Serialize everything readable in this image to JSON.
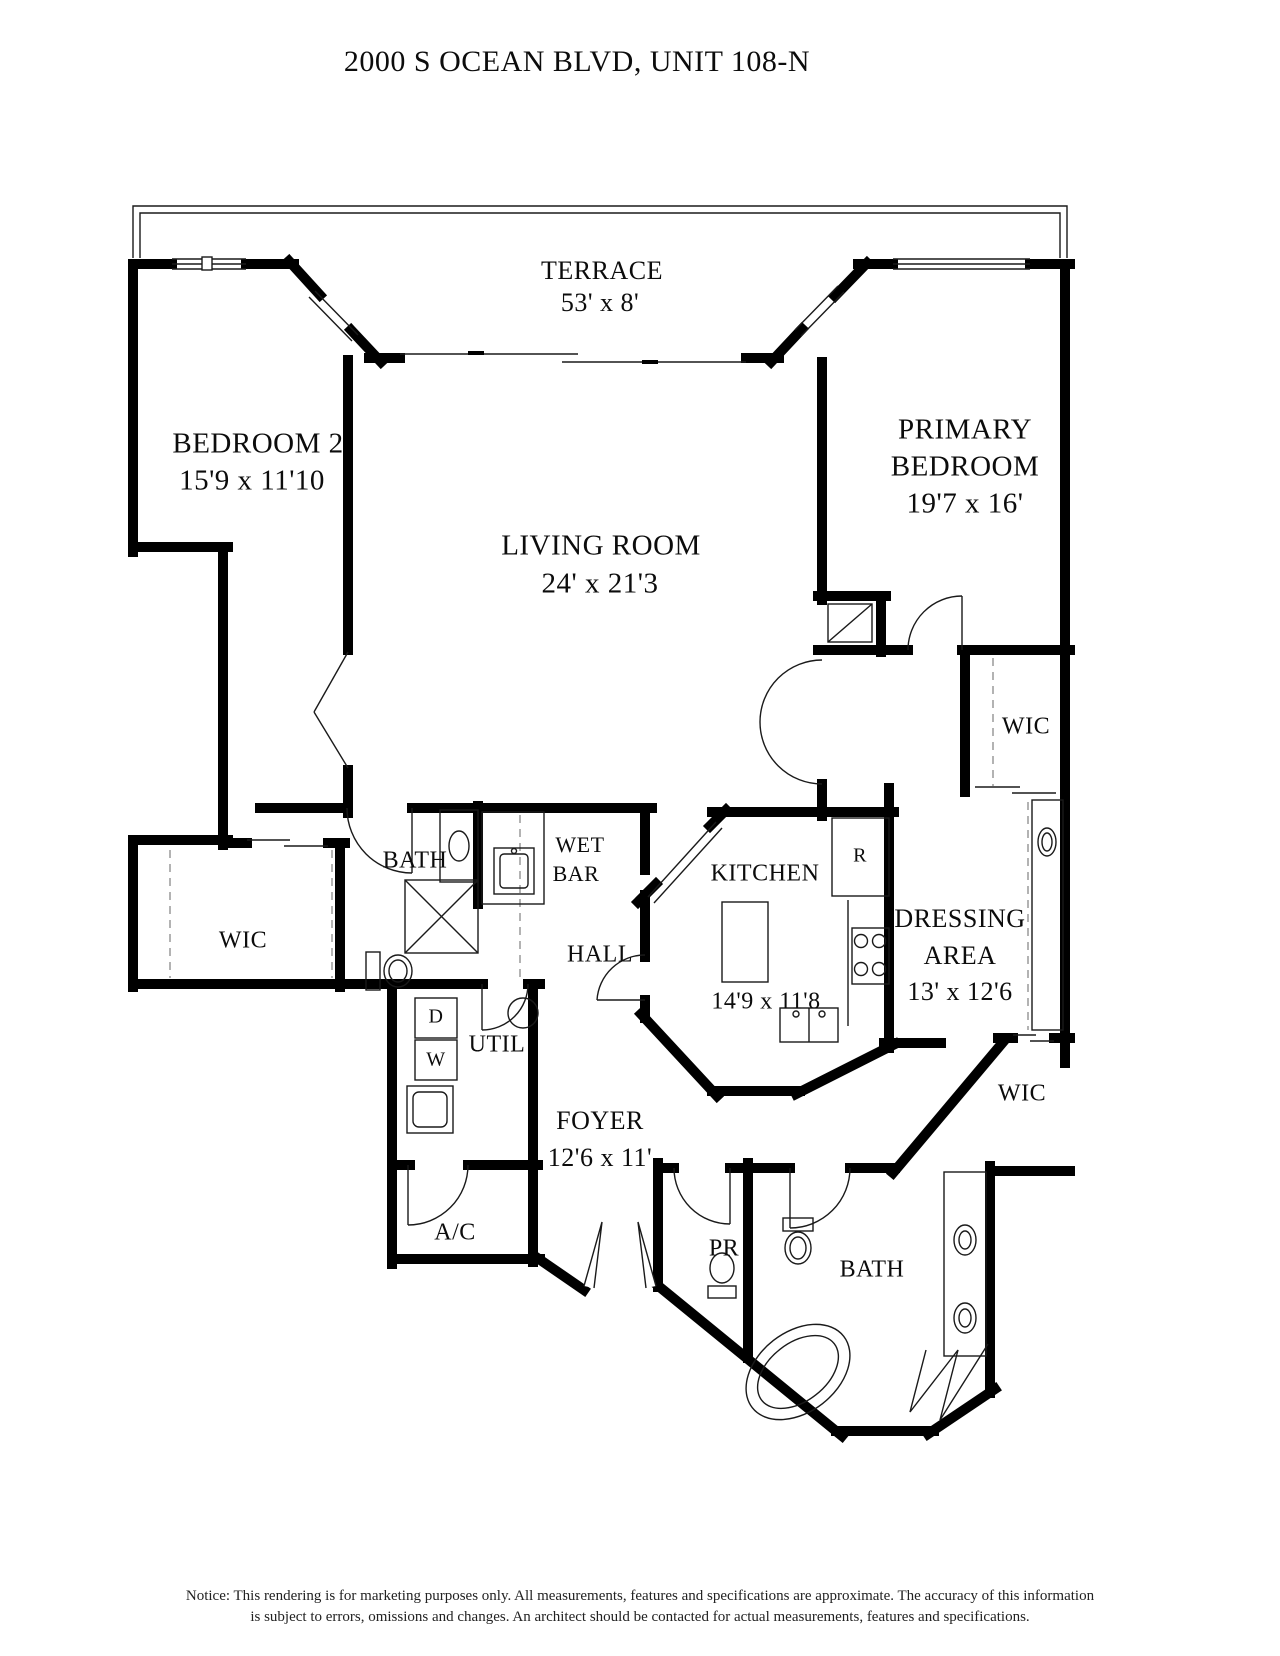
{
  "title": "2000 S OCEAN BLVD, UNIT 108-N",
  "rooms": {
    "terrace": {
      "name": "TERRACE",
      "dims": "53' x 8'"
    },
    "bedroom2": {
      "name": "BEDROOM 2",
      "dims": "15'9 x 11'10"
    },
    "primary": {
      "line1": "PRIMARY",
      "line2": "BEDROOM",
      "dims": "19'7 x 16'"
    },
    "living": {
      "name": "LIVING ROOM",
      "dims": "24' x 21'3"
    },
    "wic_top_right": {
      "name": "WIC"
    },
    "bath_left": {
      "name": "BATH"
    },
    "wet_bar": {
      "line1": "WET",
      "line2": "BAR"
    },
    "kitchen": {
      "name": "KITCHEN",
      "dims": "14'9 x 11'8"
    },
    "dressing": {
      "line1": "DRESSING",
      "line2": "AREA",
      "dims": "13' x 12'6"
    },
    "wic_left": {
      "name": "WIC"
    },
    "hall": {
      "name": "HALL"
    },
    "util": {
      "name": "UTIL"
    },
    "foyer": {
      "name": "FOYER",
      "dims": "12'6 x 11'"
    },
    "ac": {
      "name": "A/C"
    },
    "pr": {
      "name": "PR"
    },
    "bath_bottom": {
      "name": "BATH"
    },
    "wic_bottom_right": {
      "name": "WIC"
    }
  },
  "appliances": {
    "refrigerator": "R",
    "dryer": "D",
    "washer": "W"
  },
  "notice": {
    "line1": "Notice: This rendering is for marketing purposes only. All measurements, features and specifications are approximate. The accuracy of this information",
    "line2": "is subject to errors, omissions and changes. An architect should be contacted for actual measurements, features and specifications."
  },
  "colors": {
    "walls": "#000000",
    "background": "#ffffff",
    "dashed_lines": "#8a8a8a"
  }
}
